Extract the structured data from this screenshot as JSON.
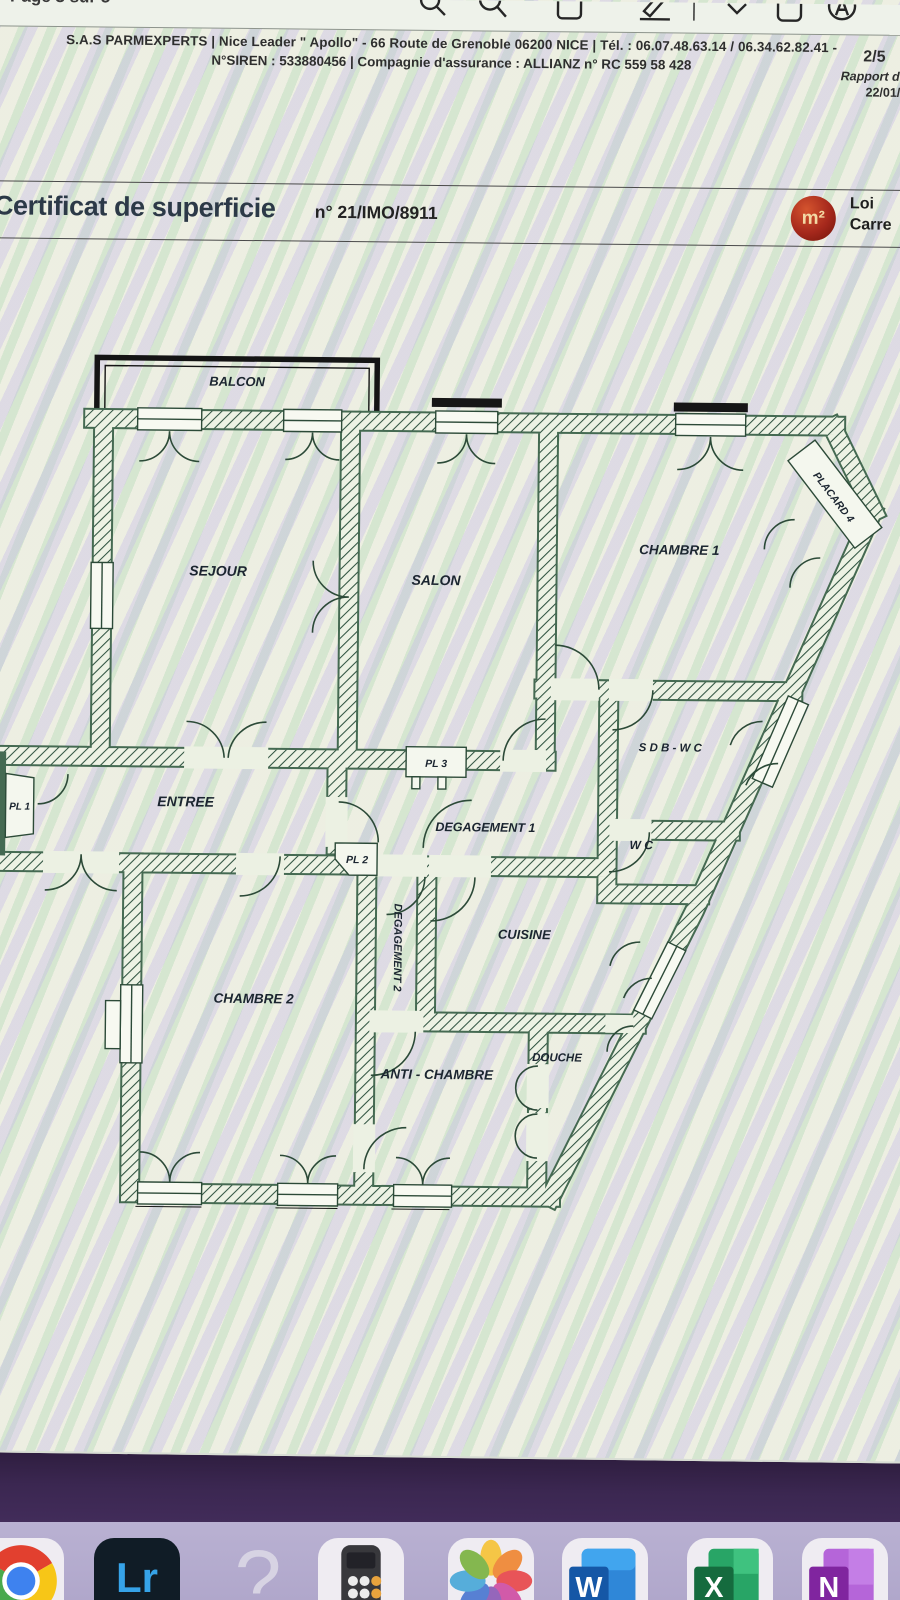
{
  "viewer": {
    "page_indicator": "Page 3 sur 5",
    "toolbar_icons": [
      "zoom-out-icon",
      "zoom-in-icon",
      "copy-icon",
      "markup-pen-icon",
      "chevron-down-icon",
      "page-icon",
      "circled-a-icon"
    ]
  },
  "document": {
    "header": {
      "line1": "S.A.S PARMEXPERTS | Nice Leader \" Apollo\" - 66 Route de Grenoble 06200 NICE | Tél. : 06.07.48.63.14 / 06.34.62.82.41 -",
      "line2": "N°SIREN : 533880456 | Compagnie d'assurance : ALLIANZ n° RC 559 58 428",
      "page_number": "2/5",
      "report_label": "Rapport du",
      "report_date": "22/01/202"
    },
    "title": {
      "main": "Certificat de superficie",
      "number": "n° 21/IMO/8911",
      "badge": "m²",
      "law_line1": "Loi",
      "law_line2": "Carre"
    },
    "plan": {
      "labels": {
        "balcon": "BALCON",
        "sejour": "SEJOUR",
        "salon": "SALON",
        "chambre1": "CHAMBRE 1",
        "placard4": "PLACARD 4",
        "sdb_wc": "S D B - W C",
        "wc": "W C",
        "entree": "ENTREE",
        "pl1": "PL 1",
        "pl3": "PL 3",
        "degagement1": "DEGAGEMENT 1",
        "pl2": "PL 2",
        "degagement2": "DEGAGEMENT 2",
        "cuisine": "CUISINE",
        "chambre2": "CHAMBRE 2",
        "anti_chambre": "ANTI - CHAMBRE",
        "douche": "DOUCHE"
      }
    }
  },
  "dock": {
    "items": [
      {
        "name": "chrome",
        "label": ""
      },
      {
        "name": "lightroom",
        "label": "Lr"
      },
      {
        "name": "missing-app",
        "label": "?"
      },
      {
        "name": "calculator",
        "label": ""
      },
      {
        "name": "photos",
        "label": ""
      },
      {
        "name": "word",
        "label": "W"
      },
      {
        "name": "excel",
        "label": "X"
      },
      {
        "name": "onenote",
        "label": "N"
      }
    ]
  },
  "colors": {
    "badge_red": "#a5281c",
    "wall_line": "#2c4a38",
    "wallpaper_purple": "#3b2751",
    "dock_bg": "#b0a7cb",
    "title_text": "#2c3947"
  }
}
